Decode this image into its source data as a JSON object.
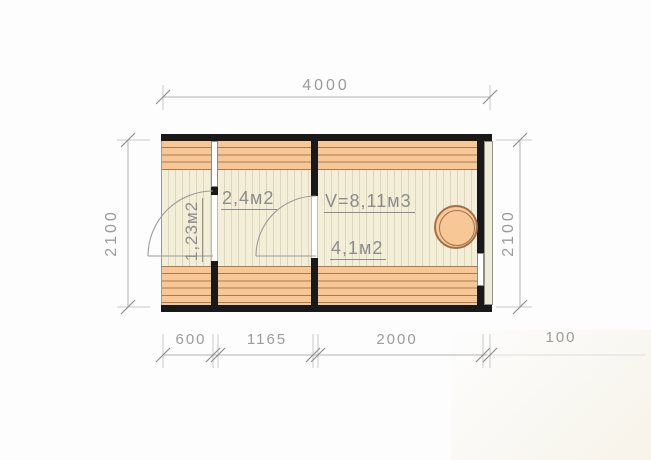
{
  "plan": {
    "dim_top": "4000",
    "dim_left": "2100",
    "dim_right": "2100",
    "dim_bottom": [
      "600",
      "1165",
      "2000",
      "100"
    ],
    "rooms": {
      "porch_area": "1,23м2",
      "middle_area": "2,4м2",
      "sauna_volume": "V=8,11м3",
      "sauna_area": "4,1м2"
    }
  },
  "colors": {
    "wall": "#191919",
    "plank_fill": "#f7c795",
    "plank_line": "#aa7b52",
    "floor_fill": "#f3eed8",
    "floor_line": "#ddd6b8",
    "dimension_gray": "#9b9b9b"
  }
}
